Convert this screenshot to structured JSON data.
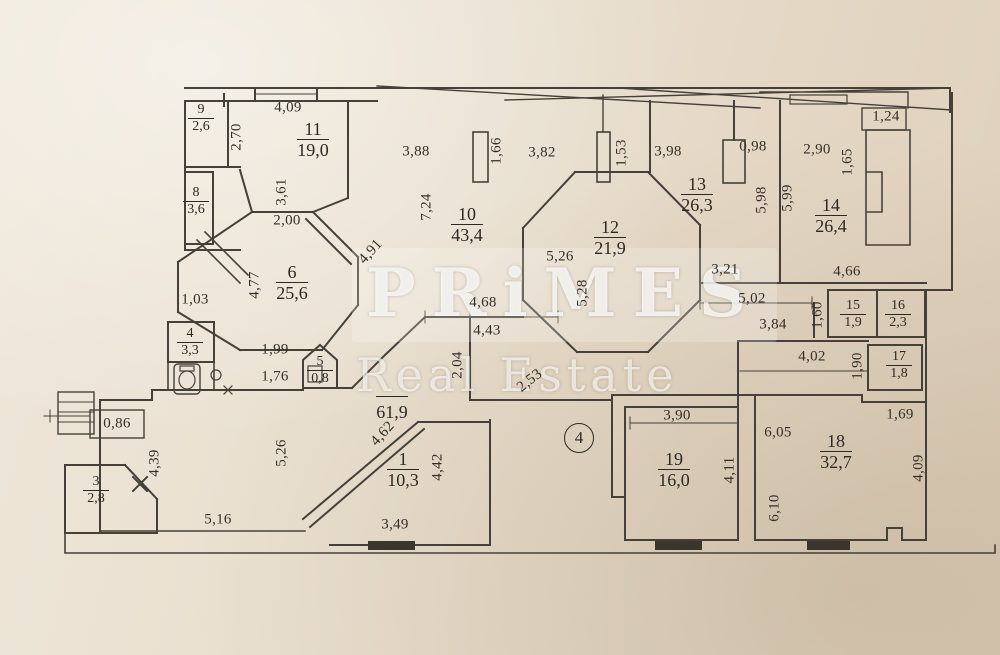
{
  "watermark": {
    "line1": "PRiMES",
    "line2": "Real Estate"
  },
  "annotation": {
    "circle_label": "4"
  },
  "rooms": [
    {
      "number": "9",
      "area": "2,6"
    },
    {
      "number": "11",
      "area": "19,0"
    },
    {
      "number": "8",
      "area": "3,6"
    },
    {
      "number": "10",
      "area": "43,4"
    },
    {
      "number": "12",
      "area": "21,9"
    },
    {
      "number": "13",
      "area": "26,3"
    },
    {
      "number": "14",
      "area": "26,4"
    },
    {
      "number": "6",
      "area": "25,6"
    },
    {
      "number": "15",
      "area": "1,9"
    },
    {
      "number": "16",
      "area": "2,3"
    },
    {
      "number": "17",
      "area": "1,8"
    },
    {
      "number": "4",
      "area": "3,3"
    },
    {
      "number": "5",
      "area": "0,8"
    },
    {
      "number": "",
      "area": "61,9"
    },
    {
      "number": "1",
      "area": "10,3"
    },
    {
      "number": "3",
      "area": "2,8"
    },
    {
      "number": "19",
      "area": "16,0"
    },
    {
      "number": "18",
      "area": "32,7"
    }
  ],
  "dimensions": [
    {
      "text": "4,09"
    },
    {
      "text": "2,70"
    },
    {
      "text": "3,61"
    },
    {
      "text": "2,00"
    },
    {
      "text": "3,88"
    },
    {
      "text": "1,66"
    },
    {
      "text": "3,82"
    },
    {
      "text": "1,53"
    },
    {
      "text": "7,24"
    },
    {
      "text": "4,91"
    },
    {
      "text": "5,26"
    },
    {
      "text": "5,28"
    },
    {
      "text": "3,98"
    },
    {
      "text": "0,98"
    },
    {
      "text": "5,98"
    },
    {
      "text": "5,99"
    },
    {
      "text": "2,90"
    },
    {
      "text": "1,65"
    },
    {
      "text": "1,24"
    },
    {
      "text": "3,21"
    },
    {
      "text": "4,66"
    },
    {
      "text": "5,02"
    },
    {
      "text": "3,84"
    },
    {
      "text": "1,60"
    },
    {
      "text": "4,02"
    },
    {
      "text": "1,90"
    },
    {
      "text": "4,77"
    },
    {
      "text": "1,03"
    },
    {
      "text": "1,99"
    },
    {
      "text": "1,76"
    },
    {
      "text": "4,68"
    },
    {
      "text": "4,43"
    },
    {
      "text": "2,04"
    },
    {
      "text": "2,53"
    },
    {
      "text": "0,86"
    },
    {
      "text": "4,39"
    },
    {
      "text": "5,26"
    },
    {
      "text": "5,16"
    },
    {
      "text": "4,62"
    },
    {
      "text": "4,42"
    },
    {
      "text": "3,49"
    },
    {
      "text": "3,90"
    },
    {
      "text": "4,11"
    },
    {
      "text": "6,05"
    },
    {
      "text": "6,10"
    },
    {
      "text": "1,69"
    },
    {
      "text": "4,09"
    }
  ]
}
